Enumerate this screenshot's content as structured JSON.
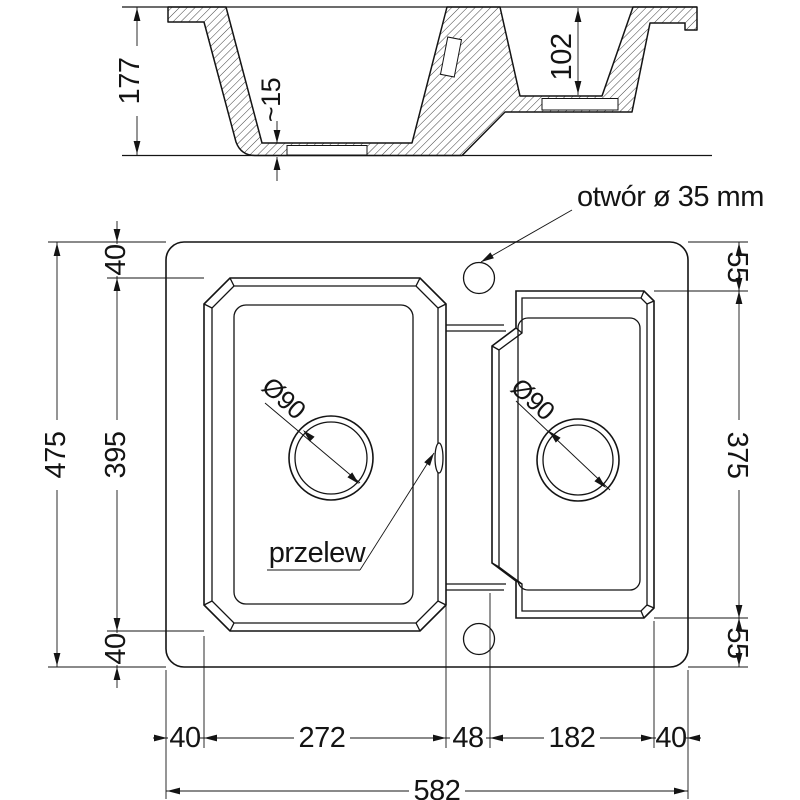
{
  "side_view": {
    "overall_height": "177",
    "small_bowl_depth": "102",
    "drain_recess_depth": "~15"
  },
  "plan_view": {
    "hole_note": "otwór ø 35 mm",
    "overflow_label": "przelew",
    "main_drain_diameter": "Ø90",
    "small_drain_diameter": "Ø90",
    "left_dims": {
      "overall": "475",
      "top_margin": "40",
      "bowl_length": "395",
      "bottom_margin": "40"
    },
    "right_dims": {
      "top_margin": "55",
      "bowl_length": "375",
      "bottom_margin": "55"
    },
    "bottom_dims": {
      "left_margin": "40",
      "main_bowl_width": "272",
      "divider": "48",
      "small_bowl_width": "182",
      "right_margin": "40",
      "overall": "582"
    }
  }
}
